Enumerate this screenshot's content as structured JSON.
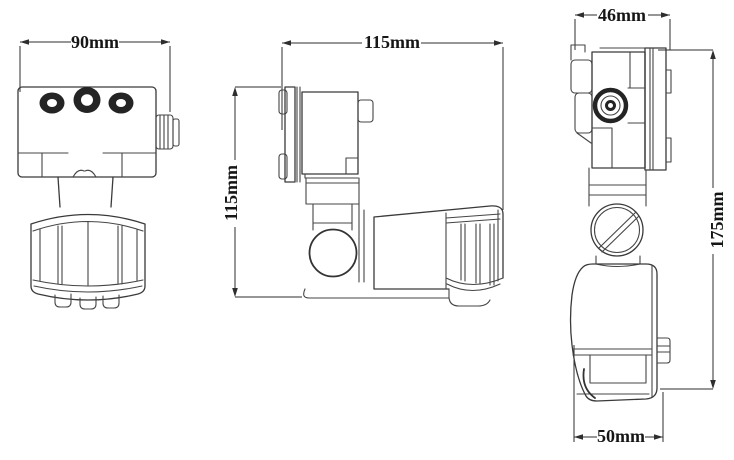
{
  "colors": {
    "background": "#ffffff",
    "line": "#3a3a3a",
    "dimension": "#2e2e2e",
    "text": "#161616",
    "dark_fill": "#242424"
  },
  "views": {
    "front": {
      "dims": {
        "width": {
          "label": "90mm",
          "orientation": "horizontal"
        }
      }
    },
    "side": {
      "dims": {
        "depth": {
          "label": "115mm",
          "orientation": "horizontal"
        },
        "height": {
          "label": "115mm",
          "orientation": "vertical"
        }
      }
    },
    "profile": {
      "dims": {
        "top_width": {
          "label": "46mm",
          "orientation": "horizontal"
        },
        "height": {
          "label": "175mm",
          "orientation": "vertical"
        },
        "bottom_width": {
          "label": "50mm",
          "orientation": "horizontal"
        }
      }
    }
  }
}
